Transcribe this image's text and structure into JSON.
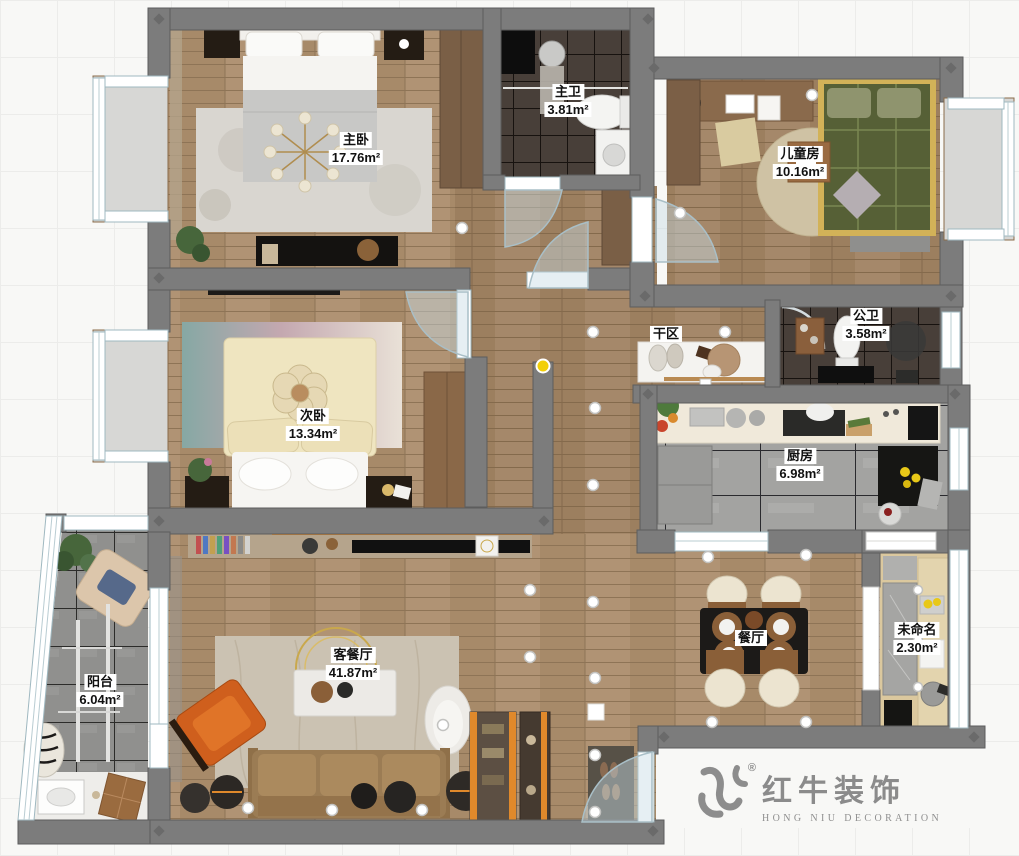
{
  "page": {
    "type": "interior-floor-plan"
  },
  "rooms": [
    {
      "id": "master-bedroom",
      "name": "主卧",
      "area": "17.76m²"
    },
    {
      "id": "master-bathroom",
      "name": "主卫",
      "area": "3.81m²"
    },
    {
      "id": "kids-room",
      "name": "儿童房",
      "area": "10.16m²"
    },
    {
      "id": "public-bathroom",
      "name": "公卫",
      "area": "3.58m²"
    },
    {
      "id": "dry-area",
      "name": "干区",
      "area": ""
    },
    {
      "id": "kitchen",
      "name": "厨房",
      "area": "6.98m²"
    },
    {
      "id": "second-bedroom",
      "name": "次卧",
      "area": "13.34m²"
    },
    {
      "id": "living-dining",
      "name": "客餐厅",
      "area": "41.87m²"
    },
    {
      "id": "dining",
      "name": "餐厅",
      "area": ""
    },
    {
      "id": "unnamed",
      "name": "未命名",
      "area": "2.30m²"
    },
    {
      "id": "balcony",
      "name": "阳台",
      "area": "6.04m²"
    }
  ],
  "watermark": {
    "brand": "红牛装饰",
    "brand_en": "HONG NIU DECORATION",
    "registered": "®"
  },
  "colors": {
    "wall": "#7c7c7c",
    "wood_floor": "#ab8f6e",
    "dark_tile": "#483f39",
    "kitchen_tile": "#a3a3a1",
    "balcony_tile": "#90908e",
    "accent_orange": "#e0892b",
    "door_arc": "#a9bfc7",
    "watermark_gray": "#8b8b8b",
    "label_bg": "#ffffff",
    "label_text": "#111111",
    "highlight_dot": "#f2cf08"
  }
}
